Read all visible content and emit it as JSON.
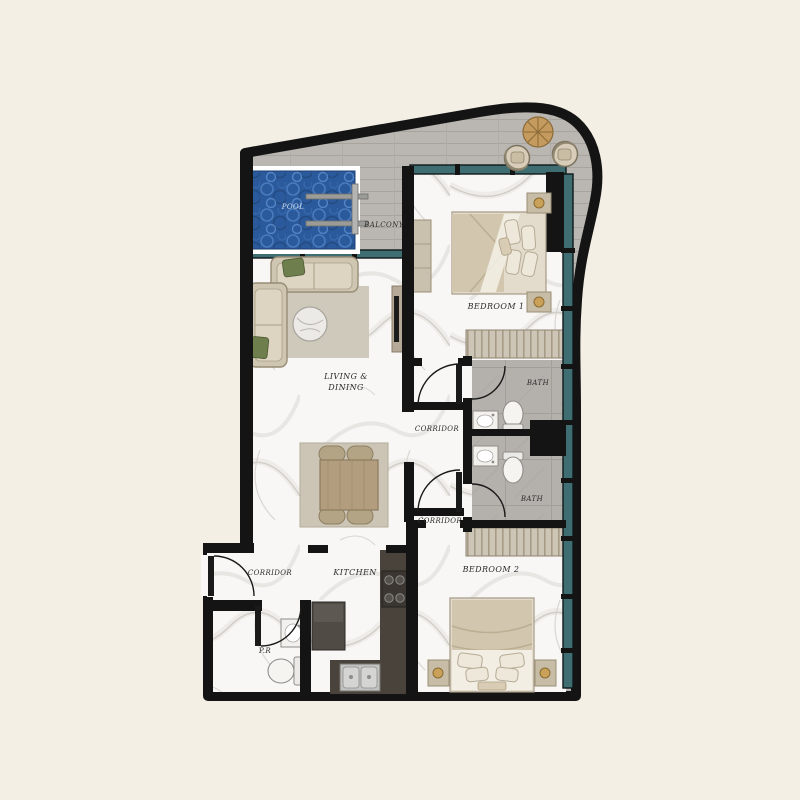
{
  "plan": {
    "rooms": {
      "pool": "POOL",
      "balcony": "BALCONY",
      "bedroom1": "BEDROOM 1",
      "bath1": "BATH",
      "bath2": "BATH",
      "living_line1": "LIVING &",
      "living_line2": "DINING",
      "corridor_mid": "CORRIDOR",
      "corridor_low": "CORRIDOR",
      "corridor_entry": "CORRIDOR",
      "kitchen": "KITCHEN",
      "bedroom2": "BEDROOM 2",
      "powder_room": "P.R"
    },
    "colors": {
      "background": "#f4efe4",
      "wall": "#141414",
      "window_glass": "#3e6e72",
      "pool_water": "#2b5a9c",
      "balcony_floor": "#bab7b2",
      "bath_floor": "#b4b1ad",
      "marble_floor": "#f8f7f5",
      "furniture": "#d0c6b2",
      "kitchen_counter": "#49433c",
      "wardrobe": "#cdc5b5"
    }
  }
}
